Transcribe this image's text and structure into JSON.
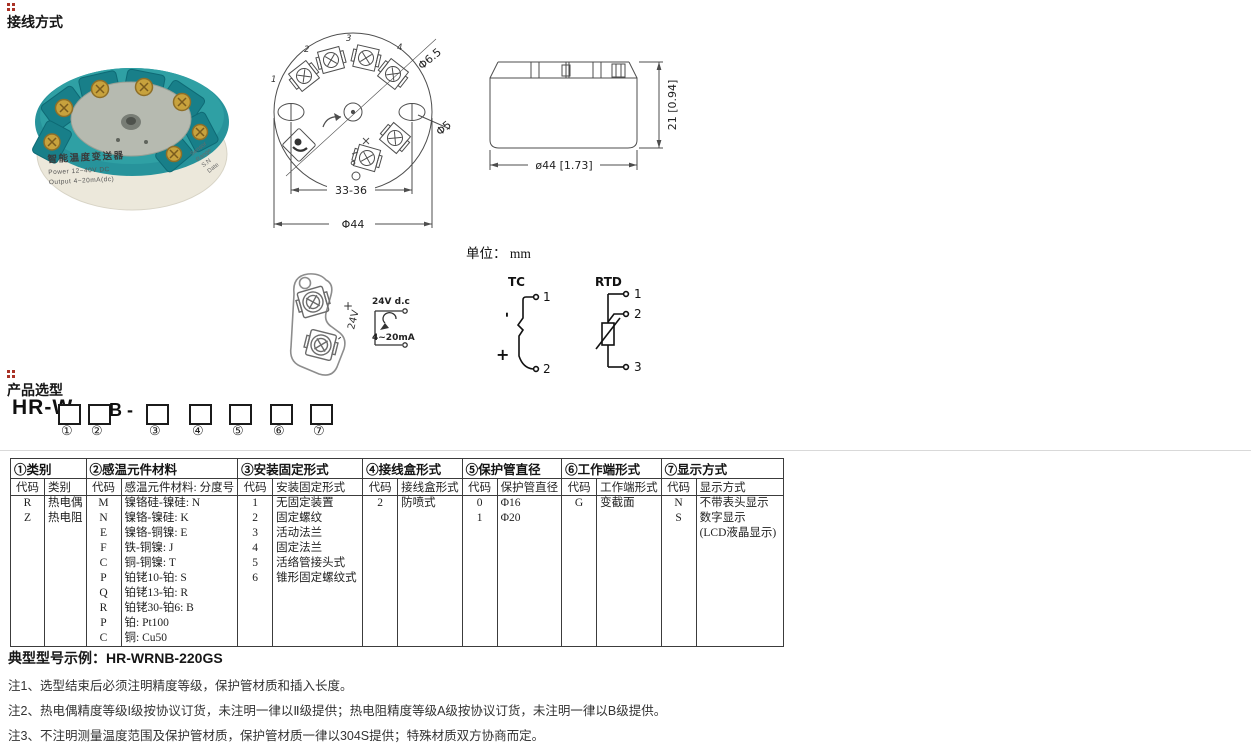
{
  "colors": {
    "product_teal": "#2c9aa0",
    "marker_red": "#a93226"
  },
  "page": {
    "section1_title": "接线方式",
    "section2_title": "产品选型",
    "unit_label": "单位： mm"
  },
  "photo": {
    "line1": "智能温度变送器",
    "line2": "Power  12~40V DC",
    "line3": "Output  4~20mA(dc)",
    "side1": "Sensor",
    "side2": "Range",
    "side3": "S.N",
    "side4": "Date"
  },
  "top_view": {
    "dim_span": "33-36",
    "dim_dia": "Φ44",
    "leader1": "Φ6.5",
    "leader2": "Φ5",
    "t1": "1",
    "t2": "2",
    "t3": "3",
    "t4": "4"
  },
  "side_view": {
    "dim_w": "ø44 [1.73]",
    "dim_h": "21 [0.94]"
  },
  "tab": {
    "plus": "+",
    "supply": "24V",
    "minus": "-"
  },
  "loop": {
    "supply": "24V d.c",
    "output": "4~20mA"
  },
  "tc": {
    "title": "TC",
    "n1": "1",
    "n2": "2",
    "minus": "-",
    "plus": "+"
  },
  "rtd": {
    "title": "RTD",
    "n1": "1",
    "n2": "2",
    "n3": "3"
  },
  "model": {
    "prefix": "HR-W",
    "fixed": "B -",
    "positions": [
      "①",
      "②",
      "③",
      "④",
      "⑤",
      "⑥",
      "⑦"
    ]
  },
  "table": {
    "groups": [
      {
        "title": "①类别",
        "col1": "代码",
        "col2": "类别",
        "rows": [
          [
            "R",
            "热电偶"
          ],
          [
            "Z",
            "热电阻"
          ]
        ]
      },
      {
        "title": "②感温元件材料",
        "col1": "代码",
        "col2": "感温元件材料: 分度号",
        "rows": [
          [
            "M",
            "镍铬硅-镍硅: N"
          ],
          [
            "N",
            "镍铬-镍硅: K"
          ],
          [
            "E",
            "镍铬-铜镍: E"
          ],
          [
            "F",
            "铁-铜镍: J"
          ],
          [
            "C",
            "铜-铜镍: T"
          ],
          [
            "P",
            "铂铑10-铂: S"
          ],
          [
            "Q",
            "铂铑13-铂: R"
          ],
          [
            "R",
            "铂铑30-铂6: B"
          ],
          [
            "P",
            "铂: Pt100"
          ],
          [
            "C",
            "铜: Cu50"
          ]
        ]
      },
      {
        "title": "③安装固定形式",
        "col1": "代码",
        "col2": "安装固定形式",
        "rows": [
          [
            "1",
            "无固定装置"
          ],
          [
            "2",
            "固定螺纹"
          ],
          [
            "3",
            "活动法兰"
          ],
          [
            "4",
            "固定法兰"
          ],
          [
            "5",
            "活络管接头式"
          ],
          [
            "6",
            "锥形固定螺纹式"
          ]
        ]
      },
      {
        "title": "④接线盒形式",
        "col1": "代码",
        "col2": "接线盒形式",
        "rows": [
          [
            "2",
            "防喷式"
          ]
        ]
      },
      {
        "title": "⑤保护管直径",
        "col1": "代码",
        "col2": "保护管直径",
        "rows": [
          [
            "0",
            "Φ16"
          ],
          [
            "1",
            "Φ20"
          ]
        ]
      },
      {
        "title": "⑥工作端形式",
        "col1": "代码",
        "col2": "工作端形式",
        "rows": [
          [
            "G",
            "变截面"
          ]
        ]
      },
      {
        "title": "⑦显示方式",
        "col1": "代码",
        "col2": "显示方式",
        "rows": [
          [
            "N",
            "不带表头显示"
          ],
          [
            "S",
            "数字显示"
          ],
          [
            "",
            "(LCD液晶显示)"
          ]
        ]
      }
    ]
  },
  "example_label": "典型型号示例：HR-WRNB-220GS",
  "notes": [
    "注1、选型结束后必须注明精度等级，保护管材质和插入长度。",
    "注2、热电偶精度等级I级按协议订货，未注明一律以Ⅱ级提供；热电阻精度等级A级按协议订货，未注明一律以B级提供。",
    "注3、不注明测量温度范围及保护管材质，保护管材质一律以304S提供；特殊材质双方协商而定。"
  ]
}
